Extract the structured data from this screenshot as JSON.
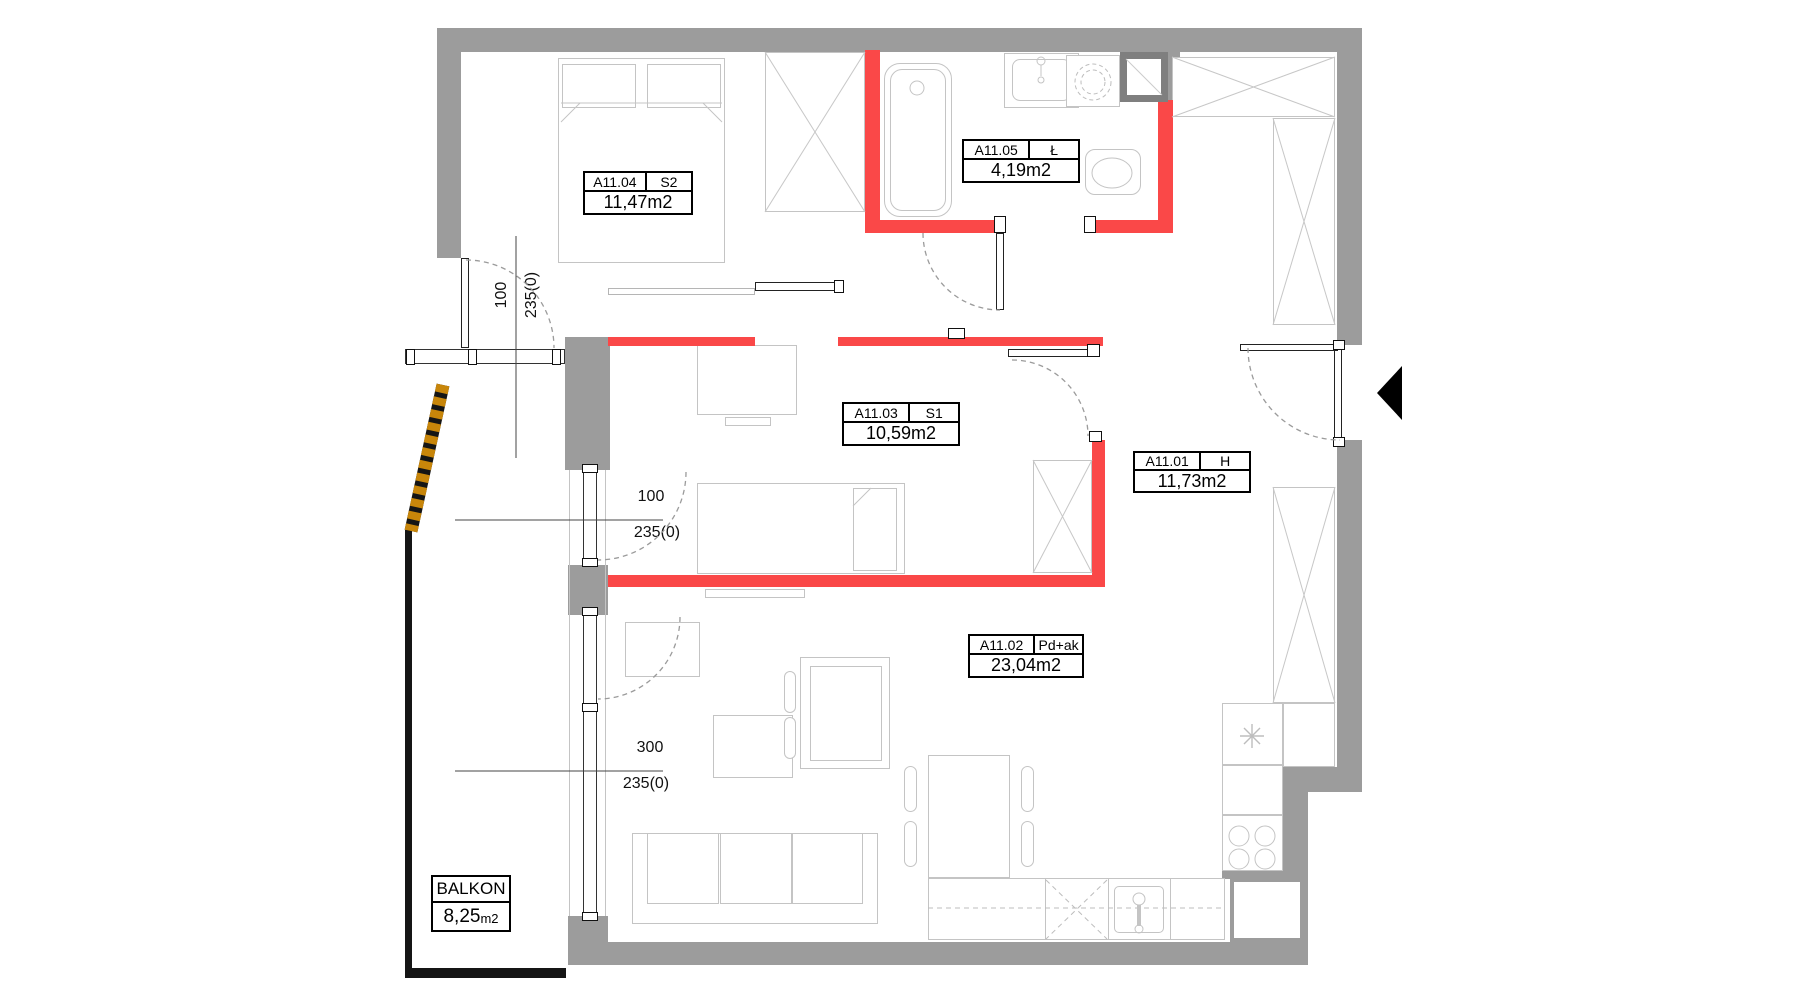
{
  "colors": {
    "wall_grey": "#9c9c9c",
    "shaft_grey": "#7f7f7f",
    "highlight_red": "#fa4848",
    "furniture_line": "#c4c4c4",
    "dash_line": "#9b9b9b",
    "balcony_screen_orange": "#c8860a",
    "railing_black": "#151515",
    "dim_line": "#444444"
  },
  "plan": {
    "rooms": [
      {
        "id": "A11.04",
        "code": "S2",
        "area": "11,47m2"
      },
      {
        "id": "A11.05",
        "code": "Ł",
        "area": "4,19m2"
      },
      {
        "id": "A11.03",
        "code": "S1",
        "area": "10,59m2"
      },
      {
        "id": "A11.01",
        "code": "H",
        "area": "11,73m2"
      },
      {
        "id": "A11.02",
        "code": "Pd+ak",
        "area": "23,04m2"
      }
    ],
    "balcony": {
      "name": "BALKON",
      "area": "8,25",
      "unit": "m2"
    },
    "dimensions": [
      {
        "width": "100",
        "height": "235(0)"
      },
      {
        "width": "100",
        "height": "235(0)"
      },
      {
        "width": "300",
        "height": "235(0)"
      }
    ]
  }
}
